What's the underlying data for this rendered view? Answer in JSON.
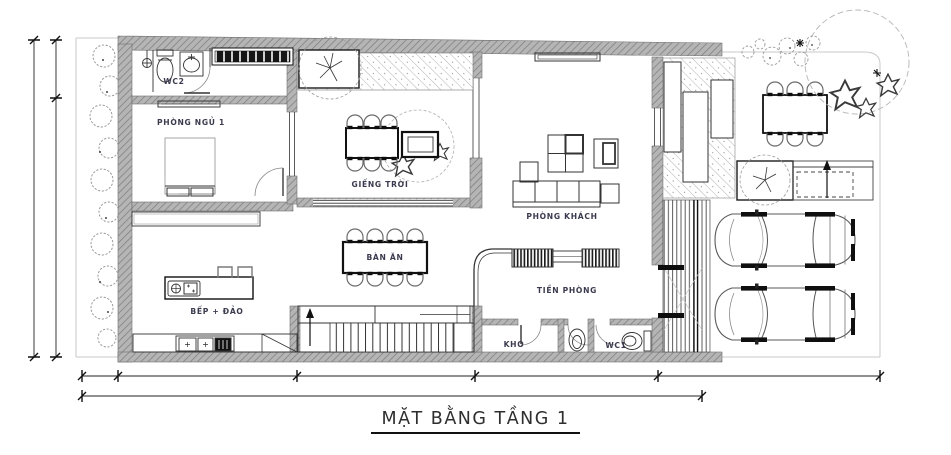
{
  "title": {
    "text": "MẶT BẰNG TẦNG 1"
  },
  "rooms": {
    "wc2": "WC2",
    "bedroom1": "PHÒNG NGỦ 1",
    "skylight": "GIẾNG TRỜI",
    "living": "PHÒNG KHÁCH",
    "dining": "BÀN ĂN",
    "kitchen": "BẾP + ĐẢO",
    "foyer": "TIỀN PHÒNG",
    "storage": "KHO",
    "wc1": "WC1"
  },
  "colors": {
    "wall_gray": "#b5b5b5",
    "wall_hatch_line": "#828282",
    "ink": "#1a1a1a",
    "label_ink": "#3b3b4f",
    "boundary_gray": "#c8c8c8",
    "deck_hatch": "#a9a9a9"
  }
}
